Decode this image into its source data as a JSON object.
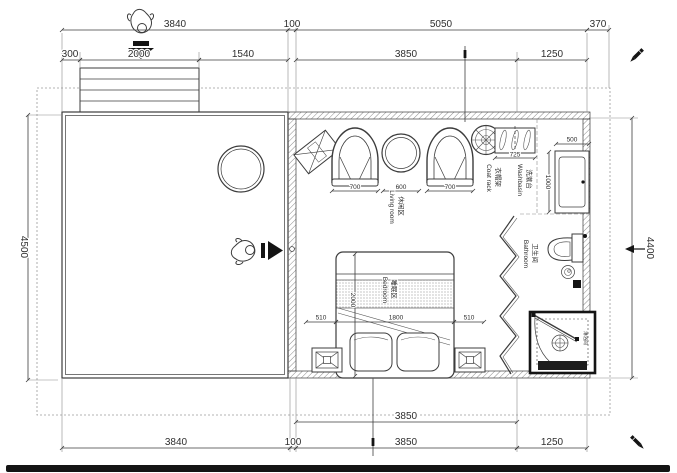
{
  "drawing": {
    "dimensions": {
      "top_row1": [
        "3840",
        "100",
        "5050",
        "370"
      ],
      "top_row2": [
        "300",
        "2000",
        "1540",
        "3850",
        "1250"
      ],
      "bottom_row1": [
        "3850"
      ],
      "bottom_row2": [
        "3840",
        "100",
        "3850",
        "1250"
      ],
      "left_height": "4500",
      "right_height": "4400",
      "living_widths": [
        "700",
        "600",
        "700"
      ],
      "coat_rack_width": "725",
      "washbasin_width": "500",
      "washbasin_depth": "1000",
      "bed_width": "1800",
      "bed_length": "2000",
      "bed_clearance_left": "510",
      "bed_clearance_right": "510"
    },
    "labels": {
      "living": {
        "cn": "休闲区",
        "en": "Living room"
      },
      "bedroom": {
        "cn": "睡眠区",
        "en": "Bedroom"
      },
      "bathroom": {
        "cn": "卫生间",
        "en": "Bathroom"
      },
      "washbasin": {
        "cn": "洗漱台",
        "en": "Washbasin"
      },
      "coatrack": {
        "cn": "衣帽架",
        "en": "Coat rack"
      },
      "shower": {
        "cn": "淋浴间"
      }
    },
    "icons": {
      "entry_person": "person-top-view",
      "entry_arrow_down": "▼",
      "entry_arrow_right": "▶",
      "pencil": "✎"
    },
    "colors": {
      "line": "#3c3c3c",
      "witness": "#8a8a8a",
      "dashed_boundary": "#9a9a9a",
      "solid_black": "#141414",
      "background": "#ffffff"
    }
  }
}
